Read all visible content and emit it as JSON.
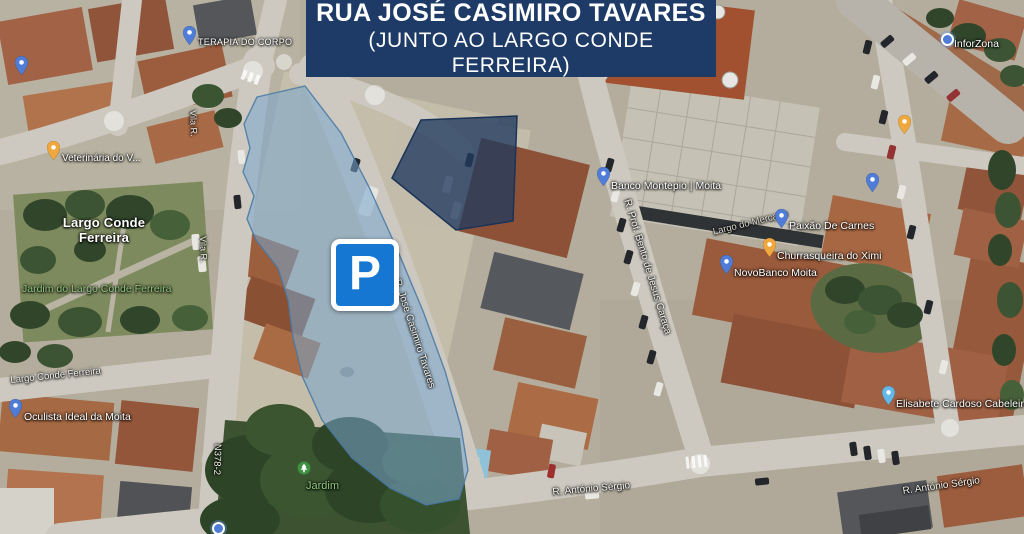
{
  "banner": {
    "title": "RUA JOSÉ CASIMIRO TAVARES",
    "subtitle": "(JUNTO AO LARGO CONDE FERREIRA)"
  },
  "parking_sign": {
    "letter": "P"
  },
  "colors": {
    "banner_bg": "#1d3b66",
    "parking_sign_blue": "#1677d2",
    "highlight_area_fill": "rgba(120,166,206,0.55)",
    "highlight_area_stroke": "rgba(70,120,165,0.85)",
    "secondary_area_fill": "rgba(33,59,95,0.78)",
    "secondary_area_stroke": "#1a3356",
    "pin_blue": "#4e7cd6",
    "pin_yellow": "#f0a73c",
    "pin_lightblue": "#62b8e8",
    "park_label_green": "#8fc57c"
  },
  "map": {
    "place_labels": [
      {
        "label": "Largo Conde Ferreira"
      }
    ],
    "park_labels": [
      {
        "label": "Jardim do Largo Conde Ferreira"
      },
      {
        "label": "Jardim"
      }
    ],
    "road_labels": [
      "Largo Conde Ferreira",
      "N378-2",
      "Vila R.",
      "Vila R.",
      "R. José Casimiro Tavares",
      "R. Prof. Bento de Jesus Caraça",
      "Largo do Mercado",
      "R. António Sérgio",
      "R. António Sérgio"
    ],
    "pois": [
      {
        "label": "TERAPIA DO CORPO",
        "pin": "blue-pin"
      },
      {
        "label": "InforZona",
        "pin": "blue-dot"
      },
      {
        "label": "Veterinária do V...",
        "pin": "yellow-pin"
      },
      {
        "label": "Oculista Ideal da Moita",
        "pin": "blue-pin"
      },
      {
        "label": "Banco Montepio | Moita",
        "pin": "blue-pin"
      },
      {
        "label": "Paixão De Carnes",
        "pin": "blue-pin"
      },
      {
        "label": "Churrasqueira do Ximi",
        "pin": "yellow-pin"
      },
      {
        "label": "NovoBanco Moita",
        "pin": "blue-pin"
      },
      {
        "label": "Elisabete Cardoso Cabeleireiro",
        "pin": "lightblue-pin"
      },
      {
        "label": "",
        "pin": "blue-pin"
      },
      {
        "label": "",
        "pin": "blue-pin"
      },
      {
        "label": "",
        "pin": "yellow-pin"
      },
      {
        "label": "",
        "pin": "blue-dot"
      }
    ]
  }
}
